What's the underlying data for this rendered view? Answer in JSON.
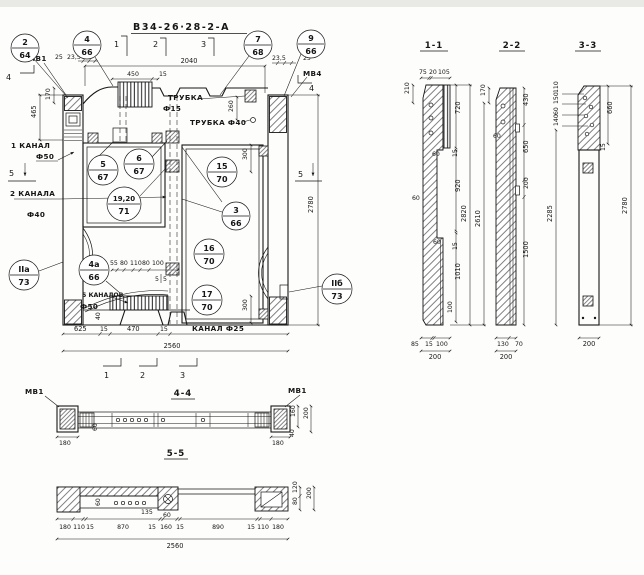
{
  "meta": {
    "title": "В34-26·28-2-А"
  },
  "bal": {
    "b2": {
      "t": "2",
      "b": "64"
    },
    "b4": {
      "t": "4",
      "b": "66"
    },
    "b7": {
      "t": "7",
      "b": "68"
    },
    "b9": {
      "t": "9",
      "b": "66"
    },
    "b5": {
      "t": "5",
      "b": "67"
    },
    "b6": {
      "t": "6",
      "b": "67"
    },
    "b1920": {
      "t": "19,20",
      "b": "71"
    },
    "b15": {
      "t": "15",
      "b": "70"
    },
    "b3": {
      "t": "3",
      "b": "66"
    },
    "b16": {
      "t": "16",
      "b": "70"
    },
    "b17": {
      "t": "17",
      "b": "70"
    },
    "b4a": {
      "t": "4а",
      "b": "66"
    },
    "bIIa": {
      "t": "IIа",
      "b": "73"
    },
    "bIIb": {
      "t": "IIб",
      "b": "73"
    }
  },
  "plan": {
    "labels": {
      "mv1": "МВ1",
      "mv4": "МВ4",
      "trubka1a": "ТРУБКА",
      "trubka1b": "Ф15",
      "trubka2": "ТРУБКА Ф40",
      "k1a": "1 КАНАЛ",
      "k1b": "Ф50",
      "k2a": "2 КАНАЛА",
      "k2b": "Ф40",
      "k5a": "5 КАНАЛОВ",
      "k5b": "Ф50",
      "k25": "КАНАЛ Ф25"
    },
    "dims": {
      "d25l": "25",
      "d235l": "23,5",
      "d450": "450",
      "d15t": "15",
      "d2040": "2040",
      "d235r": "23,5",
      "d25r": "25",
      "d465": "465",
      "d170": "170",
      "d260": "260",
      "d300t": "300",
      "d300b": "300",
      "d2780": "2780",
      "d625": "625",
      "d15a": "15",
      "d470": "470",
      "d15b": "15",
      "d2560": "2560",
      "d40": "40",
      "chain": [
        "55",
        "80",
        "110",
        "80",
        "100"
      ],
      "d5a": "5",
      "d5b": "5"
    },
    "markers": {
      "m1": "1",
      "m2": "2",
      "m3": "3",
      "m1b": "1",
      "m2b": "2",
      "m3b": "3",
      "m4l": "4",
      "m4r": "4",
      "m5l": "5",
      "m5r": "5"
    }
  },
  "s11": {
    "title": "1-1",
    "top": [
      "75",
      "20",
      "105"
    ],
    "d210": "210",
    "d720": "720",
    "d15a": "15",
    "d60a": "60",
    "d920": "920",
    "d60b": "60",
    "d60c": "60",
    "d15b": "15",
    "d1010": "1010",
    "d100": "100",
    "d2820": "2820",
    "d2610": "2610",
    "bot": [
      "85",
      "15",
      "100"
    ],
    "d200": "200"
  },
  "s22": {
    "title": "2-2",
    "d170": "170",
    "d430": "430",
    "d60": "60",
    "d650": "650",
    "d200": "200",
    "d1500": "1500",
    "d2285": "2285",
    "bot": [
      "130",
      "70"
    ],
    "d200b": "200"
  },
  "s33": {
    "title": "3-3",
    "stack": [
      "110",
      "150",
      "60",
      "140"
    ],
    "d660": "660",
    "d15": "15",
    "d2780": "2780",
    "d200": "200"
  },
  "s44": {
    "title": "4-4",
    "mvl": "МВ1",
    "mvr": "МВ1",
    "d180l": "180",
    "d60": "60",
    "d180r": "180",
    "d40": "40",
    "d160": "160",
    "d200": "200"
  },
  "s55": {
    "title": "5-5",
    "chain": [
      "180",
      "110",
      "15",
      "870",
      "15",
      "160",
      "15",
      "890",
      "15",
      "110",
      "180"
    ],
    "d2560": "2560",
    "d60a": "60",
    "d135": "135",
    "d60b": "60",
    "d120": "120",
    "d80": "80",
    "d200": "200"
  }
}
